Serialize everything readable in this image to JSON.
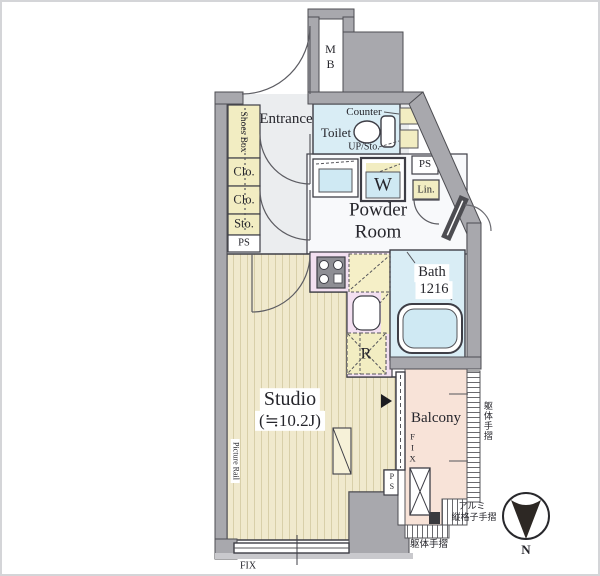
{
  "plan_title": "Studio apartment floor plan",
  "rooms": {
    "entrance": "Entrance",
    "powder_line1": "Powder",
    "powder_line2": "Room",
    "toilet": "Toilet",
    "bath_line1": "Bath",
    "bath_line2": "1216",
    "studio_line1": "Studio",
    "studio_line2": "(≒10.2J)",
    "balcony": "Balcony"
  },
  "storage": {
    "meter_box": "MB",
    "shoes_box": "Shoes Box",
    "closet1": "Clo.",
    "closet2": "Clo.",
    "storage_box": "Sto.",
    "linen": "Lin."
  },
  "fixtures": {
    "counter": "Counter",
    "up_storage": "UP/Sto.",
    "washer": "W",
    "refrigerator": "R"
  },
  "shafts": {
    "ps_left": "PS",
    "ps_right": "PS",
    "ps_bottom": "PS"
  },
  "annotations": {
    "picture_rail": "Picture Rail",
    "fix_balcony": "FIX",
    "fix_bottom": "FIX",
    "handrail_right": "躯体手摺",
    "handrail_bottom": "躯体手摺",
    "aluminum_line1": "アルミ",
    "aluminum_line2": "縦格子手摺"
  },
  "compass": {
    "north": "N"
  },
  "colors": {
    "wall": "#a8a8ad",
    "wet_area_blue": "#d9edf5",
    "closet_yellow": "#f2edc2",
    "kitchen_pink": "#f3e0f1",
    "wood_floor": "#f0e9cd",
    "balcony_peach": "#f8e3d8",
    "line_dark": "#3e3e46"
  }
}
